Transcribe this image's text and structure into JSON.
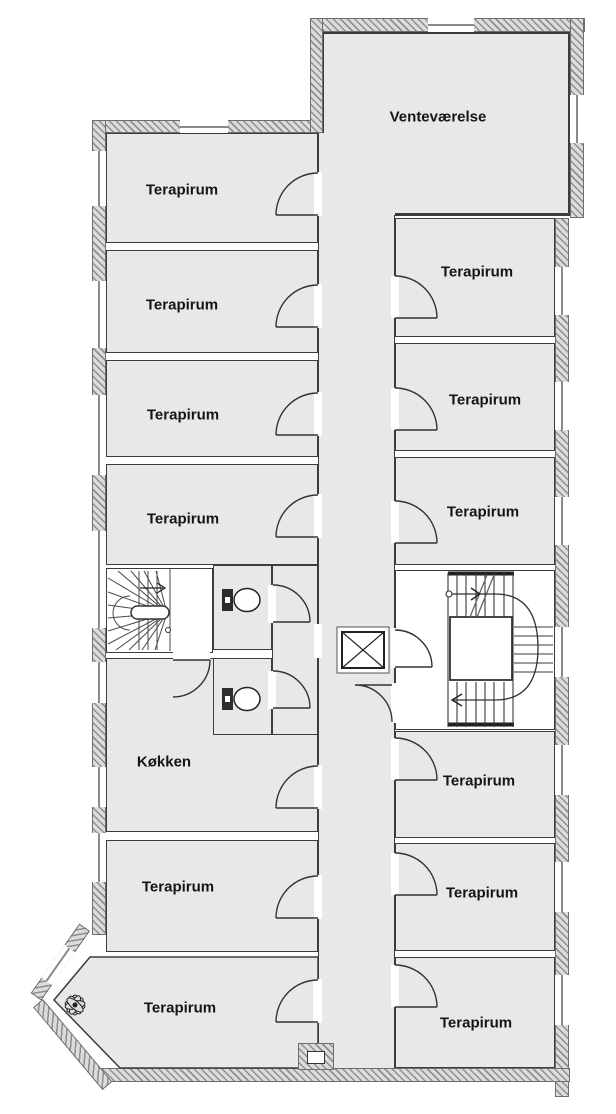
{
  "floorplan": {
    "title": "Floor plan",
    "rooms": [
      {
        "id": "ventevaerelse",
        "label": "Venteværelse"
      },
      {
        "id": "terapirum-left-1",
        "label": "Terapirum"
      },
      {
        "id": "terapirum-left-2",
        "label": "Terapirum"
      },
      {
        "id": "terapirum-left-3",
        "label": "Terapirum"
      },
      {
        "id": "terapirum-left-4",
        "label": "Terapirum"
      },
      {
        "id": "terapirum-right-1",
        "label": "Terapirum"
      },
      {
        "id": "terapirum-right-2",
        "label": "Terapirum"
      },
      {
        "id": "terapirum-right-3",
        "label": "Terapirum"
      },
      {
        "id": "koekken",
        "label": "Køkken"
      },
      {
        "id": "terapirum-left-5",
        "label": "Terapirum"
      },
      {
        "id": "terapirum-left-6",
        "label": "Terapirum"
      },
      {
        "id": "terapirum-right-4",
        "label": "Terapirum"
      },
      {
        "id": "terapirum-right-5",
        "label": "Terapirum"
      },
      {
        "id": "terapirum-right-6",
        "label": "Terapirum"
      }
    ],
    "symbols": {
      "staircases": 2,
      "elevator": 1,
      "toilets": 2,
      "plants": 1
    },
    "colors": {
      "room_fill": "#e8e8e8",
      "wall_hatch": "#8f8f8f",
      "line": "#333333"
    }
  }
}
